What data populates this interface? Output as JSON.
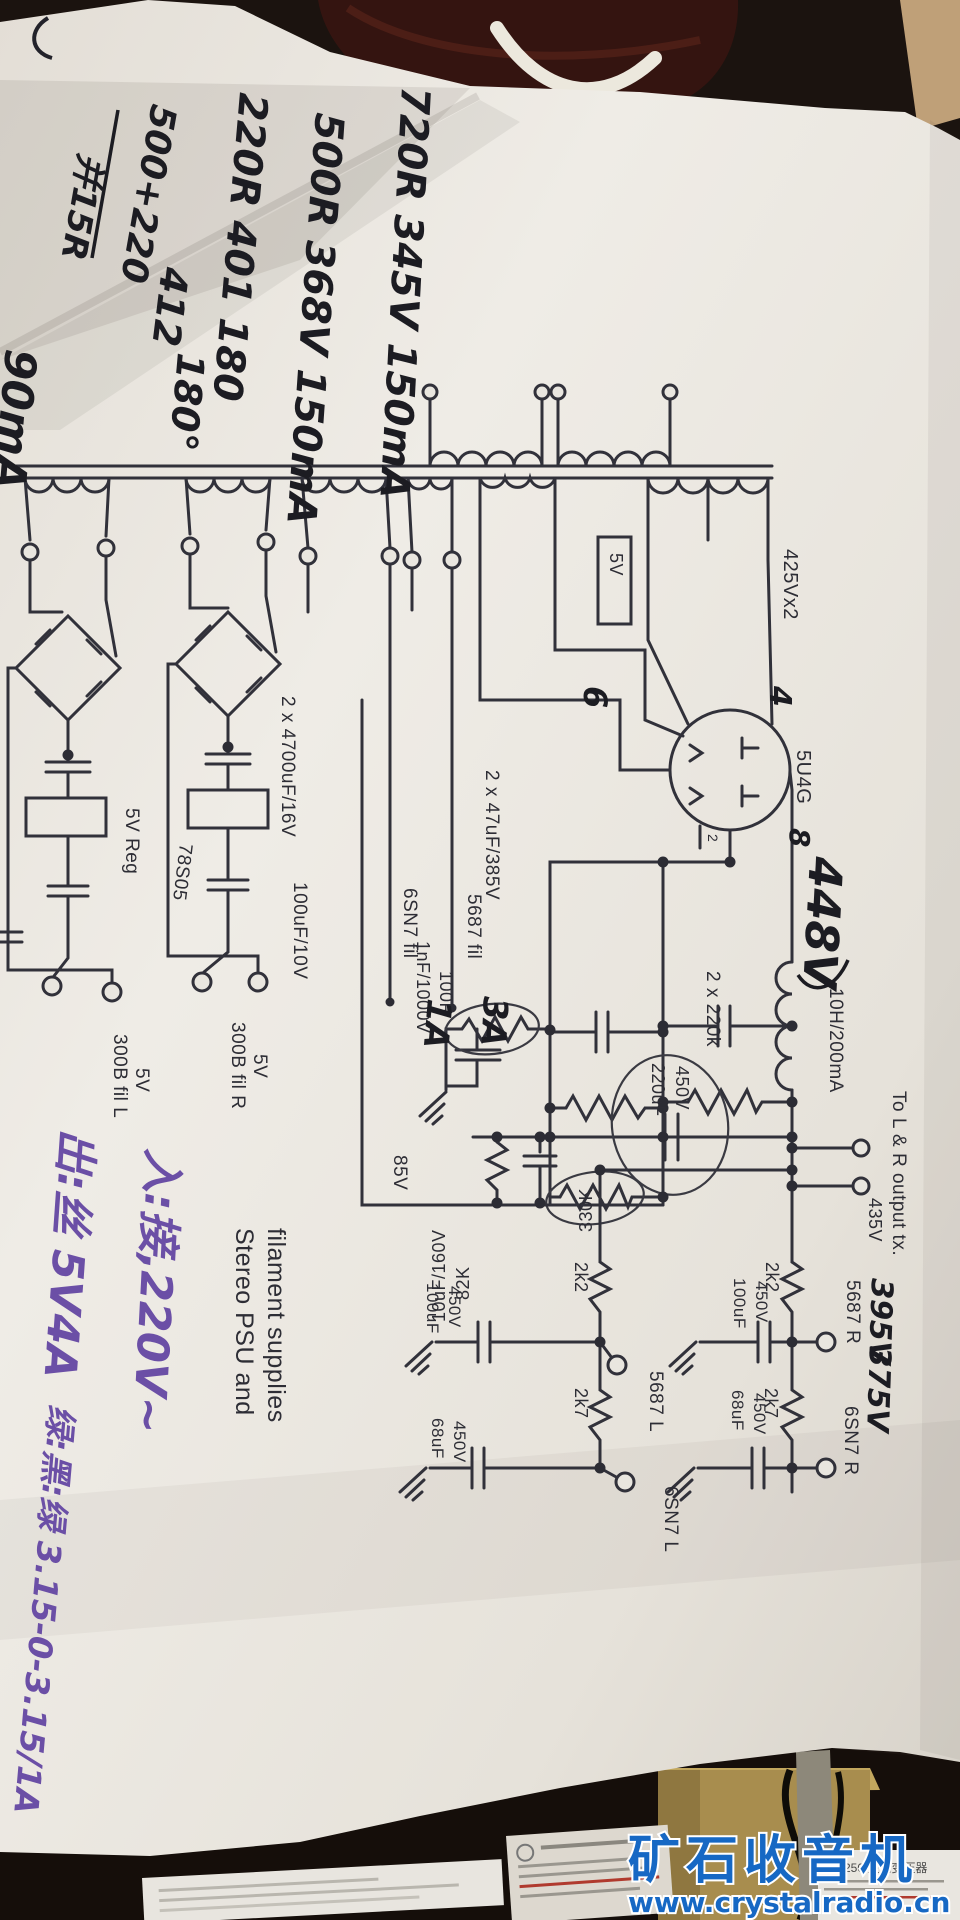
{
  "schematic": {
    "title_line1": "Stereo PSU and",
    "title_line2": "filament supplies",
    "labels": {
      "hv_winding": "425Vx2",
      "tube": "5U4G",
      "v5_box": "5V",
      "fil_6sn7": "6SN7 fil",
      "fil_5687": "5687 fil",
      "cap_4700": "2 x 4700uF/16V",
      "cap_100_10": "100uF/10V",
      "reg_5v": "5V Reg",
      "reg_78s05": "78S05",
      "fil300b_l": "300B fil L",
      "fil300b_l_v": "5V",
      "fil300b_r": "300B fil R",
      "fil300b_r_v": "5V",
      "cap_47": "2 x 47uF/385V",
      "res_220k": "2 x 220k",
      "choke": "10H/200mA",
      "res_100r": "100R",
      "cap_1nf": "1nF/1000V",
      "v85": "85V",
      "cap_10uf": "10uF/160V",
      "res_82k": "82K",
      "res_330k": "330K",
      "cap_220uf": "220uF",
      "cap_220uf_v": "450V",
      "out_tx": "To L & R output tx.",
      "v435": "435V",
      "r_2k2_r": "2k2",
      "cap100_r": "100uF",
      "cap100_r_v": "450V",
      "t_5687r": "5687 R",
      "r_2k7_r": "2k7",
      "cap68_r": "68uF",
      "cap68_r_v": "450V",
      "t_6sn7r": "6SN7 R",
      "r_2k2_l": "2k2",
      "cap100_l": "100uF",
      "cap100_l_v": "450V",
      "t_5687l": "5687 L",
      "r_2k7_l": "2k7",
      "cap68_l": "68uF",
      "cap68_l_v": "450V",
      "t_6sn7l": "6SN7 L",
      "pin2": "2"
    }
  },
  "handwriting": {
    "n1": "720R 345V 150mA",
    "n2": "500R 368V 150mA",
    "n3": "220R 401 180",
    "n4a": "500+220",
    "n4b": "并15R",
    "n4c": "412",
    "n4d": "180°",
    "edge_partial": "90mA",
    "b_plus": "448V",
    "v395": "395V",
    "v375": "375V",
    "amp_6sn7": "1A",
    "amp_5687": "3A",
    "pin4": "4",
    "pin6": "6",
    "pin8": "8"
  },
  "purple_notes": {
    "l1": "入:接,220V~",
    "l2": "出:丝 5V4A",
    "l3": "绿:黑:绿 3.15-0-3.15/1A"
  },
  "watermark": {
    "cn": "矿石收音机",
    "url": "www.crystalradio.cn"
  },
  "bottom": {
    "transformer_label": "BK-250 控制变压器"
  }
}
